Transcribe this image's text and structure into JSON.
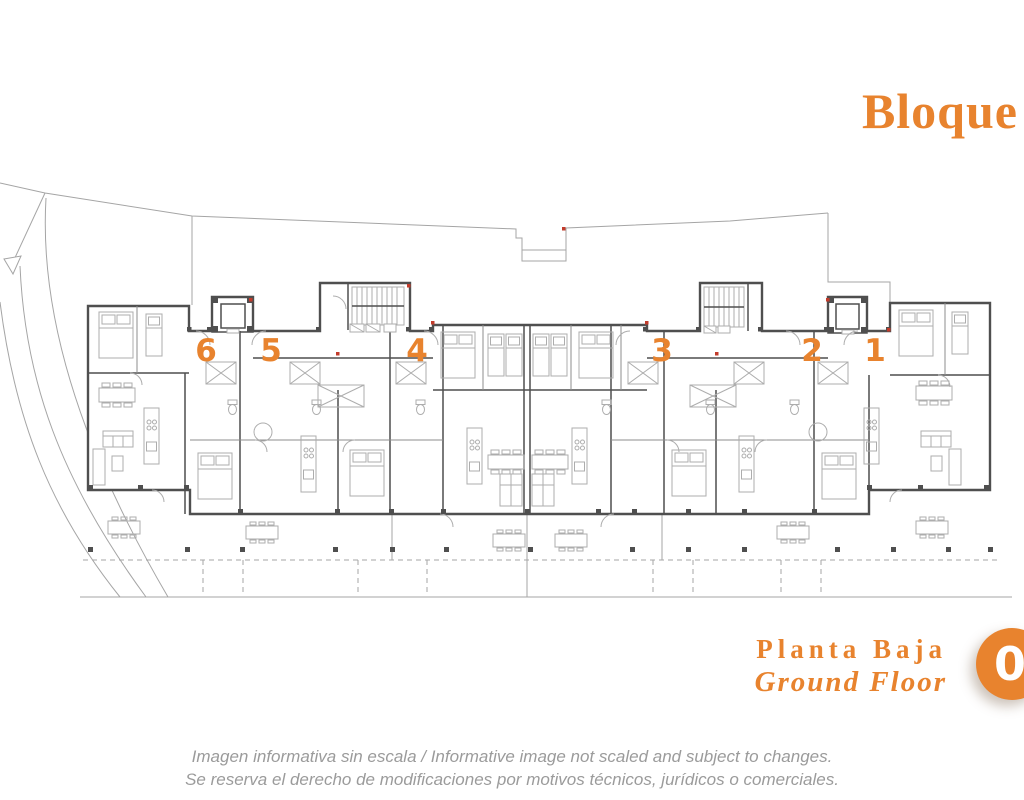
{
  "header": {
    "block_title": "Bloque"
  },
  "plan": {
    "units": [
      {
        "number": "6"
      },
      {
        "number": "5"
      },
      {
        "number": "4"
      },
      {
        "number": "3"
      },
      {
        "number": "2"
      },
      {
        "number": "1"
      }
    ]
  },
  "floor_label": {
    "spanish": "Planta Baja",
    "english": "Ground Floor",
    "floor_badge": "0"
  },
  "disclaimer": {
    "line1": "Imagen informativa sin escala /  Informative image not scaled and subject to changes.",
    "line2": "Se reserva el derecho de modificaciones por motivos técnicos, jurídicos o comerciales."
  },
  "colors": {
    "accent": "#E8832E",
    "badge_text": "#FFFFFF",
    "wall_dark": "#4F4F4F",
    "wall_light": "#8C8C8C",
    "furniture": "#ADADAD",
    "site_line": "#A5A5A5",
    "red_marker": "#C23B2B",
    "disclaimer_text": "#9B9B9B"
  }
}
